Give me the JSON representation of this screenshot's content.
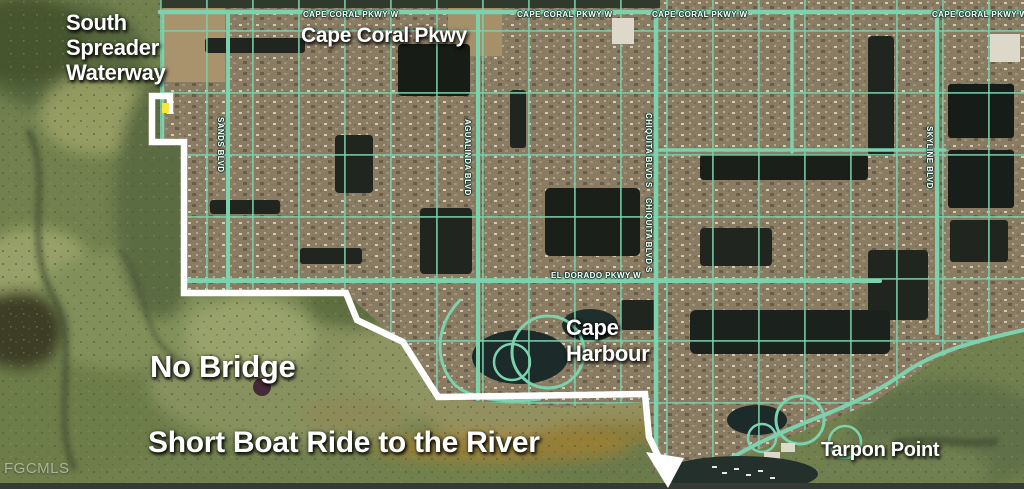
{
  "map": {
    "watermark": "FGCMLS",
    "annotations": {
      "south_spreader": {
        "line1": "South",
        "line2": "Spreader",
        "line3": "Waterway"
      },
      "cape_coral_pkwy": "Cape Coral Pkwy",
      "no_bridge": "No Bridge",
      "boat_ride": "Short Boat Ride to the River",
      "cape_harbour": {
        "line1": "Cape",
        "line2": "Harbour"
      },
      "tarpon_point": "Tarpon Point"
    },
    "street_labels": {
      "horizontal": [
        {
          "text": "CAPE CORAL PKWY W",
          "x": 303,
          "y": 10
        },
        {
          "text": "CAPE CORAL PKWY W",
          "x": 517,
          "y": 10
        },
        {
          "text": "CAPE CORAL PKWY W",
          "x": 652,
          "y": 10
        },
        {
          "text": "CAPE CORAL PKWY W",
          "x": 932,
          "y": 10
        },
        {
          "text": "EL DORADO PKWY W",
          "x": 551,
          "y": 271
        }
      ],
      "vertical": [
        {
          "text": "SANDS BLVD",
          "x": 225,
          "y": 117
        },
        {
          "text": "AGUALINDA BLVD",
          "x": 472,
          "y": 119
        },
        {
          "text": "CHIQUITA BLVD S",
          "x": 653,
          "y": 113
        },
        {
          "text": "CHIQUITA BLVD S",
          "x": 653,
          "y": 198
        },
        {
          "text": "SKYLINE BLVD",
          "x": 934,
          "y": 126
        }
      ]
    },
    "boundary": {
      "points": "170,114 170,96 152,96 152,142 184,142 184,293 346,293 357,320 403,342 438,397 645,394 649,437 662,464",
      "arrowhead": "646,452 684,458 668,488"
    },
    "property_marker": {
      "x": 162,
      "y": 103,
      "width": 7,
      "height": 10
    },
    "colors": {
      "boundary": "#ffffff",
      "marker": "#f5e73e",
      "street_highlight": "#7bd2ad",
      "label_text": "#ffffff",
      "watermark_text": "#dfe4df"
    }
  }
}
